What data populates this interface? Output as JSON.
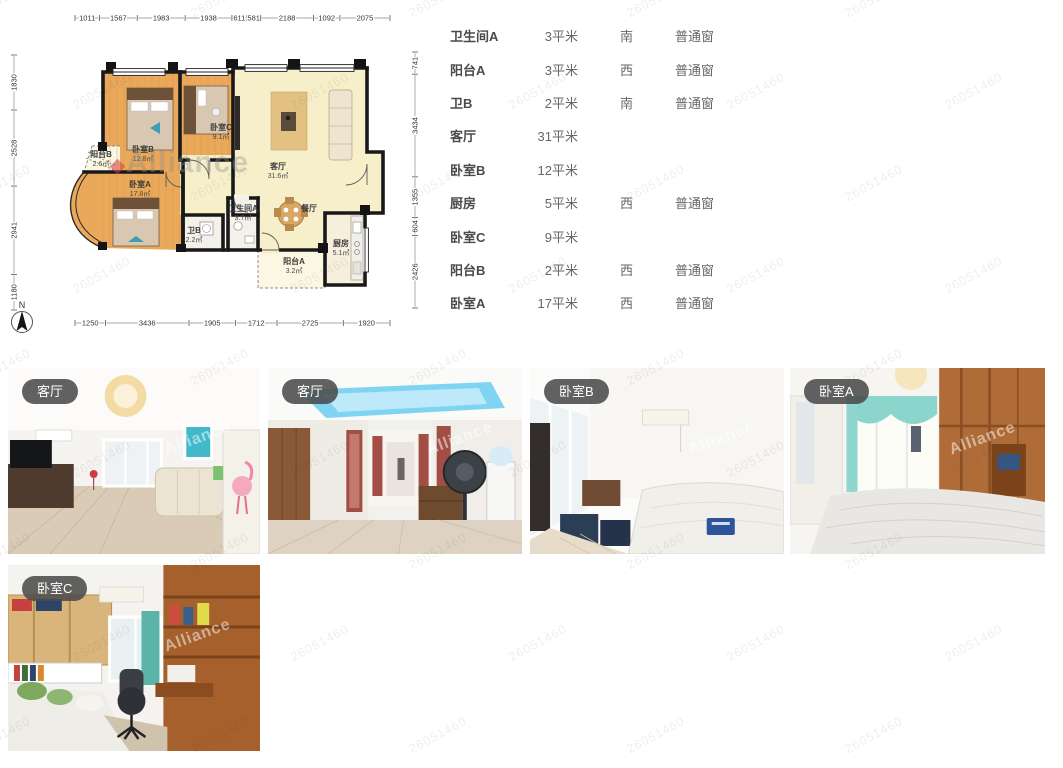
{
  "page": {
    "watermark_id": "26051460",
    "watermark_brand": "Alliance"
  },
  "floorplan": {
    "north_label": "N",
    "rooms": [
      {
        "name": "阳台B",
        "area": "2.6㎡",
        "x": 101,
        "y": 157,
        "fs": 6.5
      },
      {
        "name": "卧室B",
        "area": "12.8㎡",
        "x": 143,
        "y": 152,
        "fs": 8
      },
      {
        "name": "卧室C",
        "area": "9.1㎡",
        "x": 221,
        "y": 130,
        "fs": 7.5
      },
      {
        "name": "卧室A",
        "area": "17.8㎡",
        "x": 140,
        "y": 187,
        "fs": 8
      },
      {
        "name": "客厅",
        "area": "31.6㎡",
        "x": 278,
        "y": 169,
        "fs": 8.5
      },
      {
        "name": "卫生间A",
        "area": "3.7㎡",
        "x": 243,
        "y": 211,
        "fs": 6.5
      },
      {
        "name": "卫B",
        "area": "2.2㎡",
        "x": 194,
        "y": 233,
        "fs": 6.5
      },
      {
        "name": "餐厅",
        "area": "",
        "x": 309,
        "y": 211,
        "fs": 7
      },
      {
        "name": "厨房",
        "area": "5.1㎡",
        "x": 341,
        "y": 246,
        "fs": 7
      },
      {
        "name": "阳台A",
        "area": "3.2㎡",
        "x": 294,
        "y": 264,
        "fs": 7
      }
    ],
    "dims_top": [
      "1011",
      "1567",
      "1983",
      "1938",
      "611",
      "581",
      "2188",
      "1092",
      "2075"
    ],
    "dims_bottom": [
      "1250",
      "3436",
      "1905",
      "1712",
      "2725",
      "1920"
    ],
    "dims_left": [
      "1830",
      "2528",
      "2941",
      "1180"
    ],
    "dims_right": [
      "741",
      "3434",
      "1355",
      "604",
      "2426"
    ]
  },
  "room_table": {
    "rows": [
      {
        "name": "卫生间A",
        "size": "3平米",
        "orientation": "南",
        "window": "普通窗"
      },
      {
        "name": "阳台A",
        "size": "3平米",
        "orientation": "西",
        "window": "普通窗"
      },
      {
        "name": "卫B",
        "size": "2平米",
        "orientation": "南",
        "window": "普通窗"
      },
      {
        "name": "客厅",
        "size": "31平米",
        "orientation": "",
        "window": ""
      },
      {
        "name": "卧室B",
        "size": "12平米",
        "orientation": "",
        "window": ""
      },
      {
        "name": "厨房",
        "size": "5平米",
        "orientation": "西",
        "window": "普通窗"
      },
      {
        "name": "卧室C",
        "size": "9平米",
        "orientation": "",
        "window": ""
      },
      {
        "name": "阳台B",
        "size": "2平米",
        "orientation": "西",
        "window": "普通窗"
      },
      {
        "name": "卧室A",
        "size": "17平米",
        "orientation": "西",
        "window": "普通窗"
      }
    ]
  },
  "gallery": {
    "photos": [
      {
        "label": "客厅"
      },
      {
        "label": "客厅"
      },
      {
        "label": "卧室B"
      },
      {
        "label": "卧室A"
      },
      {
        "label": "卧室C"
      }
    ]
  }
}
